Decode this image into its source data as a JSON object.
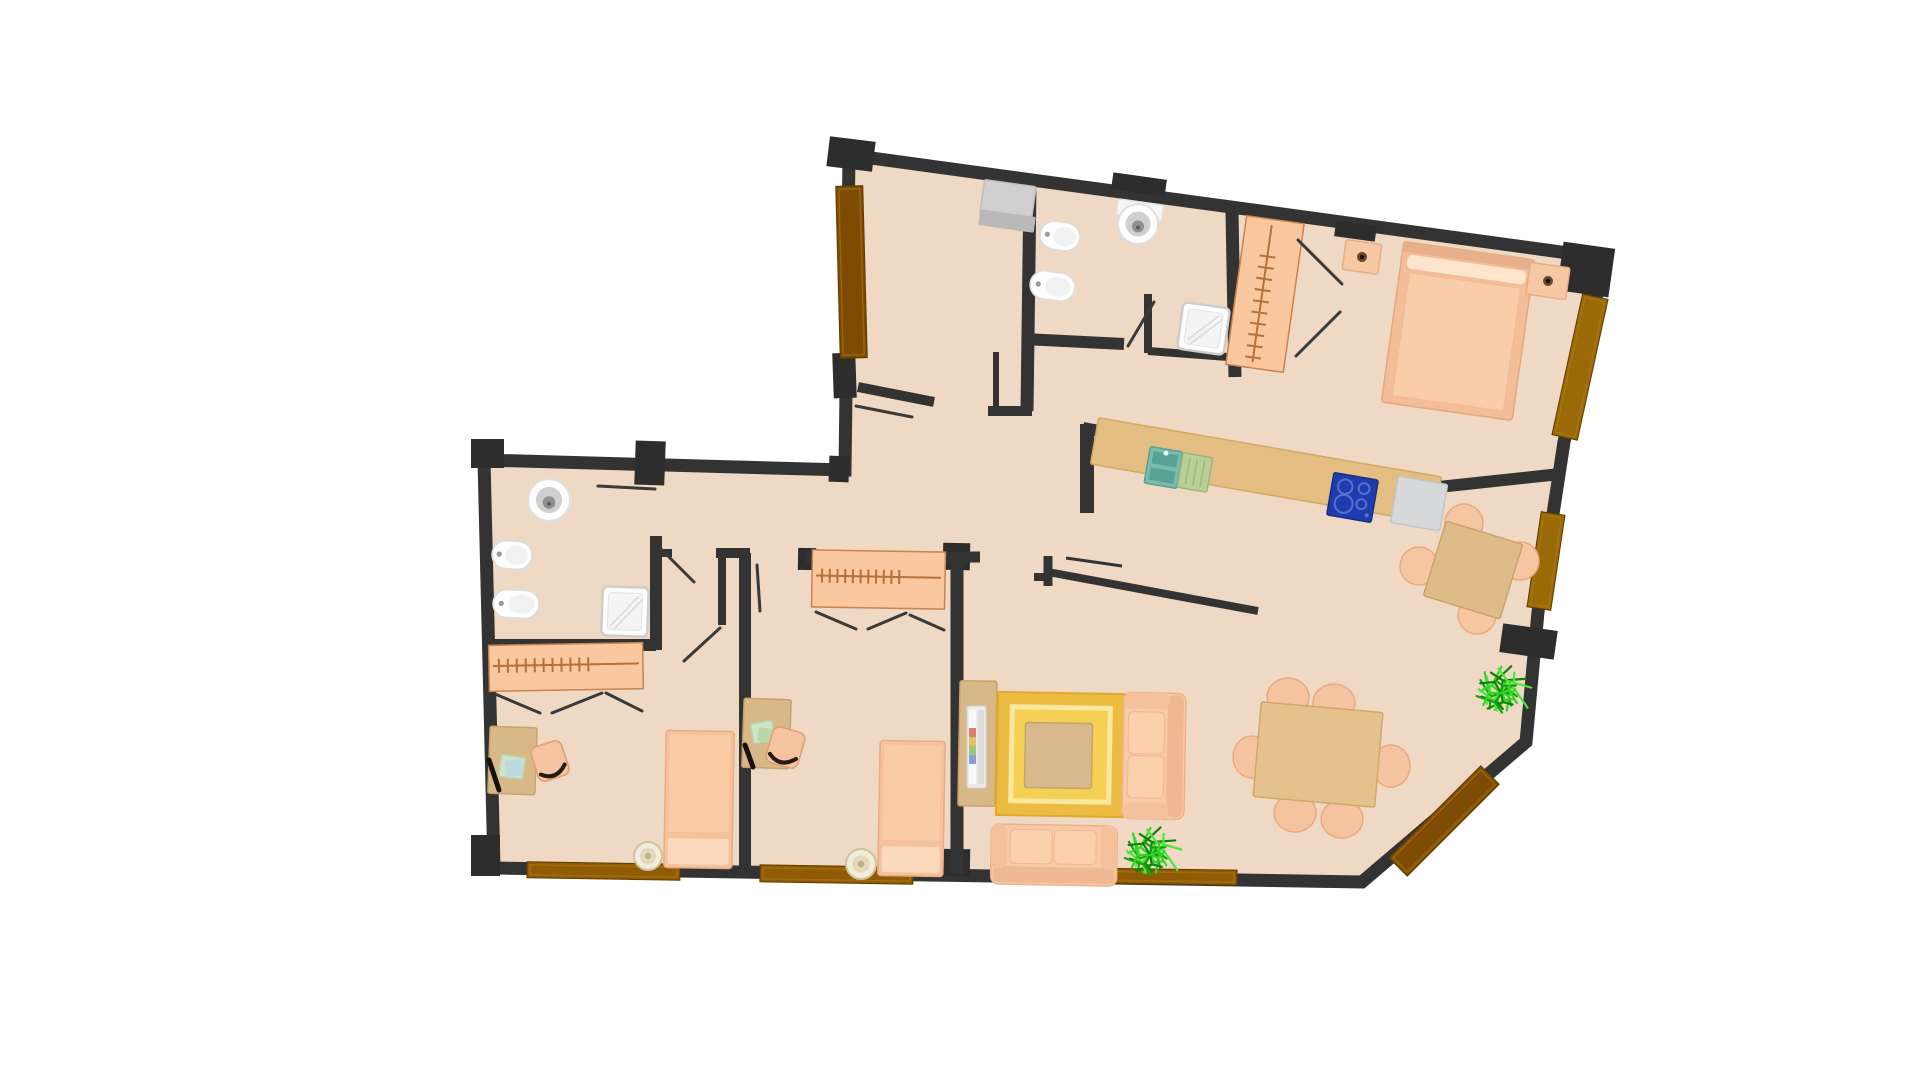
{
  "canvas": {
    "width": 1920,
    "height": 1080,
    "background": "#ffffff"
  },
  "palette": {
    "floor": "#efd9c4",
    "wall": "#333333",
    "pillar": "#2d2d2d",
    "threshold_dark": "#7d4b03",
    "threshold_mid": "#8f5c05",
    "threshold_light": "#9a6a08",
    "furniture_peach": "#f7c6a2",
    "furniture_peach_light": "#fcd9ba",
    "furniture_tan": "#dbb988",
    "wardrobe_fill": "#fac79e",
    "wardrobe_line": "#b5713c",
    "rug_outer": "#ecbc42",
    "rug_ring": "#f8e89e",
    "rug_inner": "#f5d055",
    "fixture_white": "#fdfdfd",
    "fixture_gray": "#cfcfcf",
    "appliance_gray": "#d6d8da",
    "hob_blue": "#1e3cb0",
    "sink_teal": "#79bcae",
    "drain_green": "#b9cf97",
    "counter_sand": "#e3bd82",
    "plant_green": "#2fd122",
    "leaf_line": "#3a3a3a"
  },
  "floor_plan": {
    "outline_points": "849,155 1605,258 1564,442 1538,612 1526,742 1362,882 494,868 484,460 845,470",
    "wall_width": 13,
    "pillars": [
      {
        "n": "pillar-corner-entry",
        "x": 828,
        "y": 139,
        "w": 46,
        "h": 30,
        "rot": 7
      },
      {
        "n": "pillar-top-wall-a",
        "x": 1112,
        "y": 176,
        "w": 54,
        "h": 17,
        "rot": 8
      },
      {
        "n": "pillar-top-wall-b",
        "x": 1335,
        "y": 223,
        "w": 41,
        "h": 16,
        "rot": 8
      },
      {
        "n": "pillar-corner-top-right",
        "x": 1560,
        "y": 245,
        "w": 52,
        "h": 49,
        "rot": 8
      },
      {
        "n": "pillar-corner-left-top",
        "x": 471,
        "y": 439,
        "w": 33,
        "h": 29,
        "rot": 0
      },
      {
        "n": "pillar-left-top-wall",
        "x": 635,
        "y": 441,
        "w": 30,
        "h": 44,
        "rot": 2
      },
      {
        "n": "pillar-entry-door-end",
        "x": 833,
        "y": 353,
        "w": 23,
        "h": 45,
        "rot": -2
      },
      {
        "n": "pillar-entry-step",
        "x": 829,
        "y": 456,
        "w": 20,
        "h": 26,
        "rot": 2
      },
      {
        "n": "pillar-corner-bottom-left",
        "x": 471,
        "y": 835,
        "w": 29,
        "h": 41,
        "rot": 0
      },
      {
        "n": "pillar-bedroom-wall-end",
        "x": 939,
        "y": 849,
        "w": 31,
        "h": 27,
        "rot": 1
      },
      {
        "n": "pillar-wardrobe-left",
        "x": 798,
        "y": 548,
        "w": 18,
        "h": 22,
        "rot": 1
      },
      {
        "n": "pillar-wardrobe-right",
        "x": 943,
        "y": 543,
        "w": 27,
        "h": 27,
        "rot": 1
      },
      {
        "n": "pillar-dining-stub",
        "x": 1501,
        "y": 627,
        "w": 55,
        "h": 29,
        "rot": 8
      }
    ],
    "inner_walls": [
      {
        "n": "wall-bathroom1-left",
        "x1": 1030,
        "y1": 184,
        "x2": 1027,
        "y2": 411,
        "w": 13
      },
      {
        "n": "wall-shaft-left",
        "x1": 996,
        "y1": 352,
        "x2": 996,
        "y2": 410,
        "w": 6
      },
      {
        "n": "wall-shaft-bottom",
        "x1": 988,
        "y1": 411,
        "x2": 1032,
        "y2": 411,
        "w": 10
      },
      {
        "n": "wall-bathroom1-bottom",
        "x1": 1024,
        "y1": 339,
        "x2": 1124,
        "y2": 344,
        "w": 12
      },
      {
        "n": "wall-shower1-left",
        "x1": 1148,
        "y1": 294,
        "x2": 1148,
        "y2": 353,
        "w": 8
      },
      {
        "n": "wall-shower1-bottom",
        "x1": 1148,
        "y1": 351,
        "x2": 1228,
        "y2": 357,
        "w": 8
      },
      {
        "n": "wall-bedroom1-left",
        "x1": 1232,
        "y1": 212,
        "x2": 1235,
        "y2": 377,
        "w": 13
      },
      {
        "n": "wall-kitchen-top",
        "x1": 1083,
        "y1": 428,
        "x2": 1420,
        "y2": 489,
        "w": 12
      },
      {
        "n": "wall-bedroom1-bottom",
        "x1": 1420,
        "y1": 489,
        "x2": 1560,
        "y2": 474,
        "w": 12
      },
      {
        "n": "wall-kitchen-left",
        "x1": 1087,
        "y1": 424,
        "x2": 1087,
        "y2": 513,
        "w": 14
      },
      {
        "n": "wall-living-kitchen",
        "x1": 1048,
        "y1": 572,
        "x2": 1258,
        "y2": 611,
        "w": 8
      },
      {
        "n": "wall-living-kitchen-stub",
        "x1": 1048,
        "y1": 556,
        "x2": 1048,
        "y2": 586,
        "w": 9
      },
      {
        "n": "wall-living-kitchen-stub2",
        "x1": 1034,
        "y1": 577,
        "x2": 1052,
        "y2": 577,
        "w": 8
      },
      {
        "n": "shelf-kitchen-bar",
        "x1": 1066,
        "y1": 558,
        "x2": 1122,
        "y2": 566,
        "w": 3
      },
      {
        "n": "wall-entry-closet",
        "x1": 858,
        "y1": 387,
        "x2": 934,
        "y2": 402,
        "w": 10
      },
      {
        "n": "wall-bathroom2-right",
        "x1": 656,
        "y1": 536,
        "x2": 656,
        "y2": 650,
        "w": 12
      },
      {
        "n": "wall-bathroom2-stub",
        "x1": 656,
        "y1": 553,
        "x2": 672,
        "y2": 553,
        "w": 8
      },
      {
        "n": "wall-bathroom2-bottom",
        "x1": 489,
        "y1": 645,
        "x2": 656,
        "y2": 645,
        "w": 12
      },
      {
        "n": "wall-bedrooms-divider",
        "x1": 745,
        "y1": 553,
        "x2": 745,
        "y2": 874,
        "w": 12
      },
      {
        "n": "wall-hall-jamb",
        "x1": 722,
        "y1": 557,
        "x2": 722,
        "y2": 625,
        "w": 8
      },
      {
        "n": "wall-hall-jamb-top",
        "x1": 716,
        "y1": 553,
        "x2": 750,
        "y2": 553,
        "w": 10
      },
      {
        "n": "wall-bedroom3-top",
        "x1": 806,
        "y1": 557,
        "x2": 980,
        "y2": 557,
        "w": 11
      },
      {
        "n": "wall-bedroom3-right",
        "x1": 957,
        "y1": 558,
        "x2": 957,
        "y2": 874,
        "w": 13
      }
    ],
    "thresholds": [
      {
        "n": "threshold-entry-door",
        "x": 838,
        "y": 186,
        "w": 27,
        "h": 172,
        "rot": -1.5,
        "c": "threshold_dark"
      },
      {
        "n": "threshold-balcony-bedroom1",
        "x": 1567,
        "y": 295,
        "w": 26,
        "h": 144,
        "rot": 12.3,
        "c": "threshold_light"
      },
      {
        "n": "threshold-balcony-kitchen",
        "x": 1534,
        "y": 513,
        "w": 24,
        "h": 96,
        "rot": 8.5,
        "c": "threshold_light"
      },
      {
        "n": "threshold-balcony-diagonal",
        "x": 1431,
        "y": 756,
        "w": 26,
        "h": 130,
        "rot": 45,
        "c": "threshold_dark"
      },
      {
        "n": "threshold-balcony-living",
        "x": 1075,
        "y": 869,
        "w": 162,
        "h": 15,
        "rot": 0.8,
        "c": "threshold_mid"
      },
      {
        "n": "threshold-balcony-bedroom3",
        "x": 760,
        "y": 866,
        "w": 153,
        "h": 17,
        "rot": 0.9,
        "c": "threshold_mid"
      },
      {
        "n": "threshold-balcony-bedroom2",
        "x": 527,
        "y": 863,
        "w": 153,
        "h": 16,
        "rot": 0.9,
        "c": "threshold_mid"
      }
    ],
    "furniture": [
      {
        "t": "rect",
        "n": "washing-machine",
        "x": 982,
        "y": 183,
        "w": 52,
        "h": 34,
        "rot": 8,
        "fill": "#cfcfcf",
        "stroke": "#bdbdbd"
      },
      {
        "t": "rect",
        "n": "washing-machine-front",
        "x": 979,
        "y": 213,
        "w": 56,
        "h": 16,
        "rot": 8,
        "fill": "#b9b9b9"
      },
      {
        "t": "toilet",
        "n": "toilet-bathroom1",
        "x": 1040,
        "y": 222,
        "w": 40,
        "h": 28,
        "rot": 8
      },
      {
        "t": "toilet",
        "n": "bidet-bathroom1",
        "x": 1030,
        "y": 272,
        "w": 45,
        "h": 28,
        "rot": 8
      },
      {
        "t": "rect",
        "n": "washbasin-shelf",
        "x": 1117,
        "y": 202,
        "w": 46,
        "h": 16,
        "rot": 8,
        "fill": "#f6f6f6",
        "stroke": "#e2e2e2"
      },
      {
        "t": "sinkround",
        "n": "washbasin-bathroom1",
        "cx": 1138,
        "cy": 224,
        "r": 20
      },
      {
        "t": "shower",
        "n": "shower-tray-bathroom1",
        "x": 1180,
        "y": 305,
        "w": 47,
        "h": 47,
        "rot": 8
      },
      {
        "t": "wardrobe",
        "n": "wardrobe-bedroom1",
        "x": 1236,
        "y": 219,
        "w": 58,
        "h": 150,
        "rot": 8,
        "orient": "v"
      },
      {
        "t": "nightstand",
        "n": "nightstand-left",
        "x": 1344,
        "y": 242,
        "w": 36,
        "h": 30,
        "rot": 8
      },
      {
        "t": "bed2",
        "n": "double-bed",
        "x": 1392,
        "y": 250,
        "w": 132,
        "h": 162,
        "rot": 8
      },
      {
        "t": "nightstand",
        "n": "nightstand-right",
        "x": 1528,
        "y": 265,
        "w": 40,
        "h": 32,
        "rot": 8
      },
      {
        "t": "rect",
        "n": "kitchen-counter",
        "x": 1092,
        "y": 447,
        "w": 348,
        "h": 47,
        "rot": 9.8,
        "fill": "#e3bd82",
        "stroke": "#d3a865"
      },
      {
        "t": "ksink",
        "n": "kitchen-sink",
        "x": 1147,
        "y": 449,
        "w": 33,
        "h": 37,
        "rot": 9.8
      },
      {
        "t": "drain",
        "n": "drainboard",
        "x": 1180,
        "y": 455,
        "w": 30,
        "h": 35,
        "rot": 9.8
      },
      {
        "t": "hob",
        "n": "cooktop",
        "x": 1330,
        "y": 476,
        "w": 45,
        "h": 43,
        "rot": 9.8
      },
      {
        "t": "rect",
        "n": "dishwasher",
        "x": 1394,
        "y": 480,
        "w": 50,
        "h": 47,
        "rot": 9.8,
        "fill": "#d6d8da",
        "stroke": "#c2c4c6"
      },
      {
        "t": "circle",
        "n": "chair-round-table-n",
        "cx": 1464,
        "cy": 523,
        "r": 19,
        "fill": "#f6c5a2",
        "stroke": "#eaaa80"
      },
      {
        "t": "circle",
        "n": "chair-round-table-w",
        "cx": 1419,
        "cy": 566,
        "r": 19,
        "fill": "#f6c5a2",
        "stroke": "#eaaa80"
      },
      {
        "t": "circle",
        "n": "chair-round-table-e",
        "cx": 1520,
        "cy": 561,
        "r": 19,
        "fill": "#f6c5a2",
        "stroke": "#eaaa80"
      },
      {
        "t": "circle",
        "n": "chair-round-table-s",
        "cx": 1477,
        "cy": 615,
        "r": 19,
        "fill": "#f6c5a2",
        "stroke": "#eaaa80"
      },
      {
        "t": "rect",
        "n": "breakfast-table",
        "x": 1433,
        "y": 531,
        "w": 80,
        "h": 78,
        "rot": 17,
        "fill": "#debb88",
        "stroke": "#c9a368"
      },
      {
        "t": "ellipse",
        "n": "dining-chair-1",
        "cx": 1288,
        "cy": 697,
        "rx": 21,
        "ry": 19,
        "fill": "#f6c3a0",
        "stroke": "#eaaa80"
      },
      {
        "t": "ellipse",
        "n": "dining-chair-2",
        "cx": 1334,
        "cy": 703,
        "rx": 21,
        "ry": 19,
        "fill": "#f6c3a0",
        "stroke": "#eaaa80"
      },
      {
        "t": "ellipse",
        "n": "dining-chair-3",
        "cx": 1252,
        "cy": 757,
        "rx": 19,
        "ry": 21,
        "fill": "#f6c3a0",
        "stroke": "#eaaa80"
      },
      {
        "t": "ellipse",
        "n": "dining-chair-4",
        "cx": 1391,
        "cy": 766,
        "rx": 19,
        "ry": 21,
        "fill": "#f6c3a0",
        "stroke": "#eaaa80"
      },
      {
        "t": "ellipse",
        "n": "dining-chair-5",
        "cx": 1295,
        "cy": 813,
        "rx": 21,
        "ry": 19,
        "fill": "#f6c3a0",
        "stroke": "#eaaa80"
      },
      {
        "t": "ellipse",
        "n": "dining-chair-6",
        "cx": 1342,
        "cy": 819,
        "rx": 21,
        "ry": 19,
        "fill": "#f6c3a0",
        "stroke": "#eaaa80"
      },
      {
        "t": "rect",
        "n": "dining-table",
        "x": 1257,
        "y": 707,
        "w": 122,
        "h": 95,
        "rot": 5,
        "fill": "#e4c18d",
        "stroke": "#d0a868"
      },
      {
        "t": "rect",
        "n": "tv-cabinet",
        "x": 959,
        "y": 681,
        "w": 37,
        "h": 125,
        "rot": 1,
        "fill": "#d9b887",
        "stroke": "#c7a36e"
      },
      {
        "t": "tv",
        "n": "television",
        "x": 967,
        "y": 706
      },
      {
        "t": "rug",
        "n": "area-rug",
        "x": 997,
        "y": 693,
        "w": 127,
        "h": 123,
        "rot": 1
      },
      {
        "t": "rect",
        "n": "coffee-table",
        "x": 1025,
        "y": 723,
        "w": 67,
        "h": 65,
        "rot": 1,
        "fill": "#d7b98d",
        "stroke": "#c6a36f"
      },
      {
        "t": "sofa",
        "n": "loveseat-side",
        "x": 1123,
        "y": 693,
        "w": 62,
        "h": 126,
        "rot": 1,
        "back": "e"
      },
      {
        "t": "sofa",
        "n": "loveseat-bottom",
        "x": 991,
        "y": 825,
        "w": 126,
        "h": 60,
        "rot": 1,
        "back": "s"
      },
      {
        "t": "sinkround",
        "n": "washbasin-bathroom2",
        "cx": 549,
        "cy": 500,
        "r": 21
      },
      {
        "t": "toilet",
        "n": "toilet-bathroom2",
        "x": 492,
        "y": 541,
        "w": 40,
        "h": 28,
        "rot": 4
      },
      {
        "t": "toilet",
        "n": "bidet-bathroom2",
        "x": 493,
        "y": 590,
        "w": 46,
        "h": 28,
        "rot": 2
      },
      {
        "t": "shower",
        "n": "shower-tray-bathroom2",
        "x": 602,
        "y": 587,
        "w": 46,
        "h": 49,
        "rot": 2
      },
      {
        "t": "wardrobe",
        "n": "wardrobe-bedroom2",
        "x": 489,
        "y": 644,
        "w": 154,
        "h": 46,
        "rot": -1,
        "orient": "h"
      },
      {
        "t": "rect",
        "n": "desk-bedroom2",
        "x": 489,
        "y": 727,
        "w": 47,
        "h": 67,
        "rot": 2,
        "fill": "#d9b887",
        "stroke": "#c7a36e"
      },
      {
        "t": "rect",
        "n": "paper-bedroom2",
        "x": 500,
        "y": 756,
        "w": 24,
        "h": 22,
        "rot": 8,
        "fill": "#cfe3c8",
        "stroke": "#b8d2ae"
      },
      {
        "t": "rect",
        "n": "paper-bedroom2-b",
        "x": 506,
        "y": 760,
        "w": 16,
        "h": 16,
        "rot": -6,
        "fill": "#bcd8e2"
      },
      {
        "t": "line",
        "n": "keyboard-bedroom2",
        "x1": 489,
        "y1": 760,
        "x2": 499,
        "y2": 790,
        "w": 5,
        "color": "#15130f"
      },
      {
        "t": "chair",
        "n": "desk-chair-bedroom2",
        "x": 534,
        "y": 743,
        "w": 32,
        "h": 36,
        "rot": -18
      },
      {
        "t": "bed1",
        "n": "single-bed-bedroom2",
        "x": 665,
        "y": 731,
        "w": 68,
        "h": 137,
        "rot": 1
      },
      {
        "t": "pouf",
        "n": "pouf-bedroom2",
        "cx": 648,
        "cy": 856,
        "r": 14
      },
      {
        "t": "wardrobe",
        "n": "wardrobe-bedroom3",
        "x": 812,
        "y": 551,
        "w": 133,
        "h": 57,
        "rot": 1,
        "orient": "h"
      },
      {
        "t": "rect",
        "n": "desk-bedroom3",
        "x": 743,
        "y": 699,
        "w": 47,
        "h": 69,
        "rot": 2,
        "fill": "#d9b887",
        "stroke": "#c7a36e"
      },
      {
        "t": "rect",
        "n": "paper-bedroom3",
        "x": 752,
        "y": 722,
        "w": 22,
        "h": 20,
        "rot": -10,
        "fill": "#cfe3c8",
        "stroke": "#b8d2ae"
      },
      {
        "t": "rect",
        "n": "paper-bedroom3-b",
        "x": 758,
        "y": 728,
        "w": 14,
        "h": 14,
        "rot": 8,
        "fill": "#b9d7a9"
      },
      {
        "t": "line",
        "n": "keyboard-bedroom3",
        "x1": 745,
        "y1": 745,
        "x2": 753,
        "y2": 767,
        "w": 5,
        "color": "#15130f"
      },
      {
        "t": "chair",
        "n": "desk-chair-bedroom3",
        "x": 769,
        "y": 729,
        "w": 33,
        "h": 37,
        "rot": 16
      },
      {
        "t": "bed1",
        "n": "single-bed-bedroom3",
        "x": 879,
        "y": 741,
        "w": 65,
        "h": 135,
        "rot": 1
      },
      {
        "t": "pouf",
        "n": "pouf-bedroom3",
        "cx": 861,
        "cy": 864,
        "r": 15
      }
    ],
    "door_leaves": [
      {
        "n": "door-leaf-entry-closet",
        "x1": 856,
        "y1": 406,
        "x2": 912,
        "y2": 417
      },
      {
        "n": "door-leaf-bathroom1",
        "x1": 1128,
        "y1": 346,
        "x2": 1154,
        "y2": 302
      },
      {
        "n": "door-leaf-wardrobe1-a",
        "x1": 1298,
        "y1": 240,
        "x2": 1342,
        "y2": 284
      },
      {
        "n": "door-leaf-wardrobe1-b",
        "x1": 1296,
        "y1": 356,
        "x2": 1340,
        "y2": 312
      },
      {
        "n": "door-leaf-bedroom3",
        "x1": 757,
        "y1": 565,
        "x2": 760,
        "y2": 611
      },
      {
        "n": "door-leaf-wardrobe3-a",
        "x1": 816,
        "y1": 612,
        "x2": 856,
        "y2": 629
      },
      {
        "n": "door-leaf-wardrobe3-b",
        "x1": 868,
        "y1": 629,
        "x2": 906,
        "y2": 613
      },
      {
        "n": "door-leaf-wardrobe3-c",
        "x1": 910,
        "y1": 615,
        "x2": 944,
        "y2": 630
      },
      {
        "n": "door-leaf-wardrobe2-a",
        "x1": 495,
        "y1": 694,
        "x2": 540,
        "y2": 713
      },
      {
        "n": "door-leaf-wardrobe2-b",
        "x1": 552,
        "y1": 713,
        "x2": 602,
        "y2": 693
      },
      {
        "n": "door-leaf-wardrobe2-c",
        "x1": 606,
        "y1": 693,
        "x2": 642,
        "y2": 711
      },
      {
        "n": "door-leaf-bedroom2",
        "x1": 720,
        "y1": 628,
        "x2": 684,
        "y2": 661
      },
      {
        "n": "door-leaf-bathroom2",
        "x1": 660,
        "y1": 548,
        "x2": 694,
        "y2": 582
      },
      {
        "n": "door-marker-left-hall",
        "x1": 598,
        "y1": 486,
        "x2": 655,
        "y2": 489
      }
    ],
    "plants": [
      {
        "n": "potted-plant-dining",
        "cx": 1501,
        "cy": 693,
        "r": 32
      },
      {
        "n": "potted-plant-living",
        "cx": 1150,
        "cy": 855,
        "r": 33
      }
    ]
  }
}
